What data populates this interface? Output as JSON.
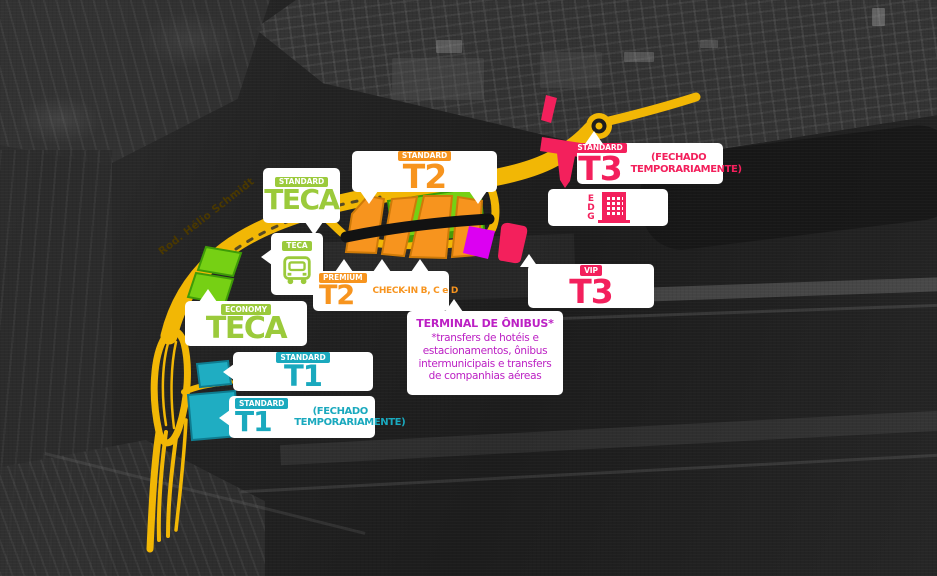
{
  "map": {
    "road_label": "Rod. Hélio Schmidt"
  },
  "colors": {
    "teca_green": "#9BCA3B",
    "building_green": "#76D014",
    "t2_orange": "#F7941E",
    "t3_pink": "#F3205C",
    "t1_cyan": "#1AA9BE",
    "bus_magenta": "#BC20C4",
    "bus_building_magenta": "#DC00F2",
    "road_yellow": "#F2B705"
  },
  "icons": {
    "teca_bus": "bus-front-icon",
    "edg": "parking-garage-building-icon",
    "roundabout": "roundabout-icon"
  },
  "labels": {
    "teca_standard": {
      "badge": "STANDARD",
      "title": "TECA"
    },
    "t2_standard": {
      "badge": "STANDARD",
      "title": "T2"
    },
    "t3_standard": {
      "badge": "STANDARD",
      "title": "T3",
      "note": "(FECHADO TEMPORARIAMENTE)"
    },
    "edg": {
      "title": "EDG"
    },
    "teca_bus": {
      "badge": "TECA"
    },
    "t2_premium": {
      "badge": "PREMIUM",
      "title": "T2",
      "note": "CHECK-IN B, C e D"
    },
    "t3_vip": {
      "badge": "VIP",
      "title": "T3"
    },
    "teca_economy": {
      "badge": "ECONOMY",
      "title": "TECA"
    },
    "bus_terminal": {
      "title": "TERMINAL DE ÔNIBUS*",
      "description": "*transfers de hotéis e estacionamentos, ônibus intermunicipais e transfers de companhias aéreas"
    },
    "t1_standard": {
      "badge": "STANDARD",
      "title": "T1"
    },
    "t1_closed": {
      "badge": "STANDARD",
      "title": "T1",
      "note": "(FECHADO TEMPORARIAMENTE)"
    }
  }
}
